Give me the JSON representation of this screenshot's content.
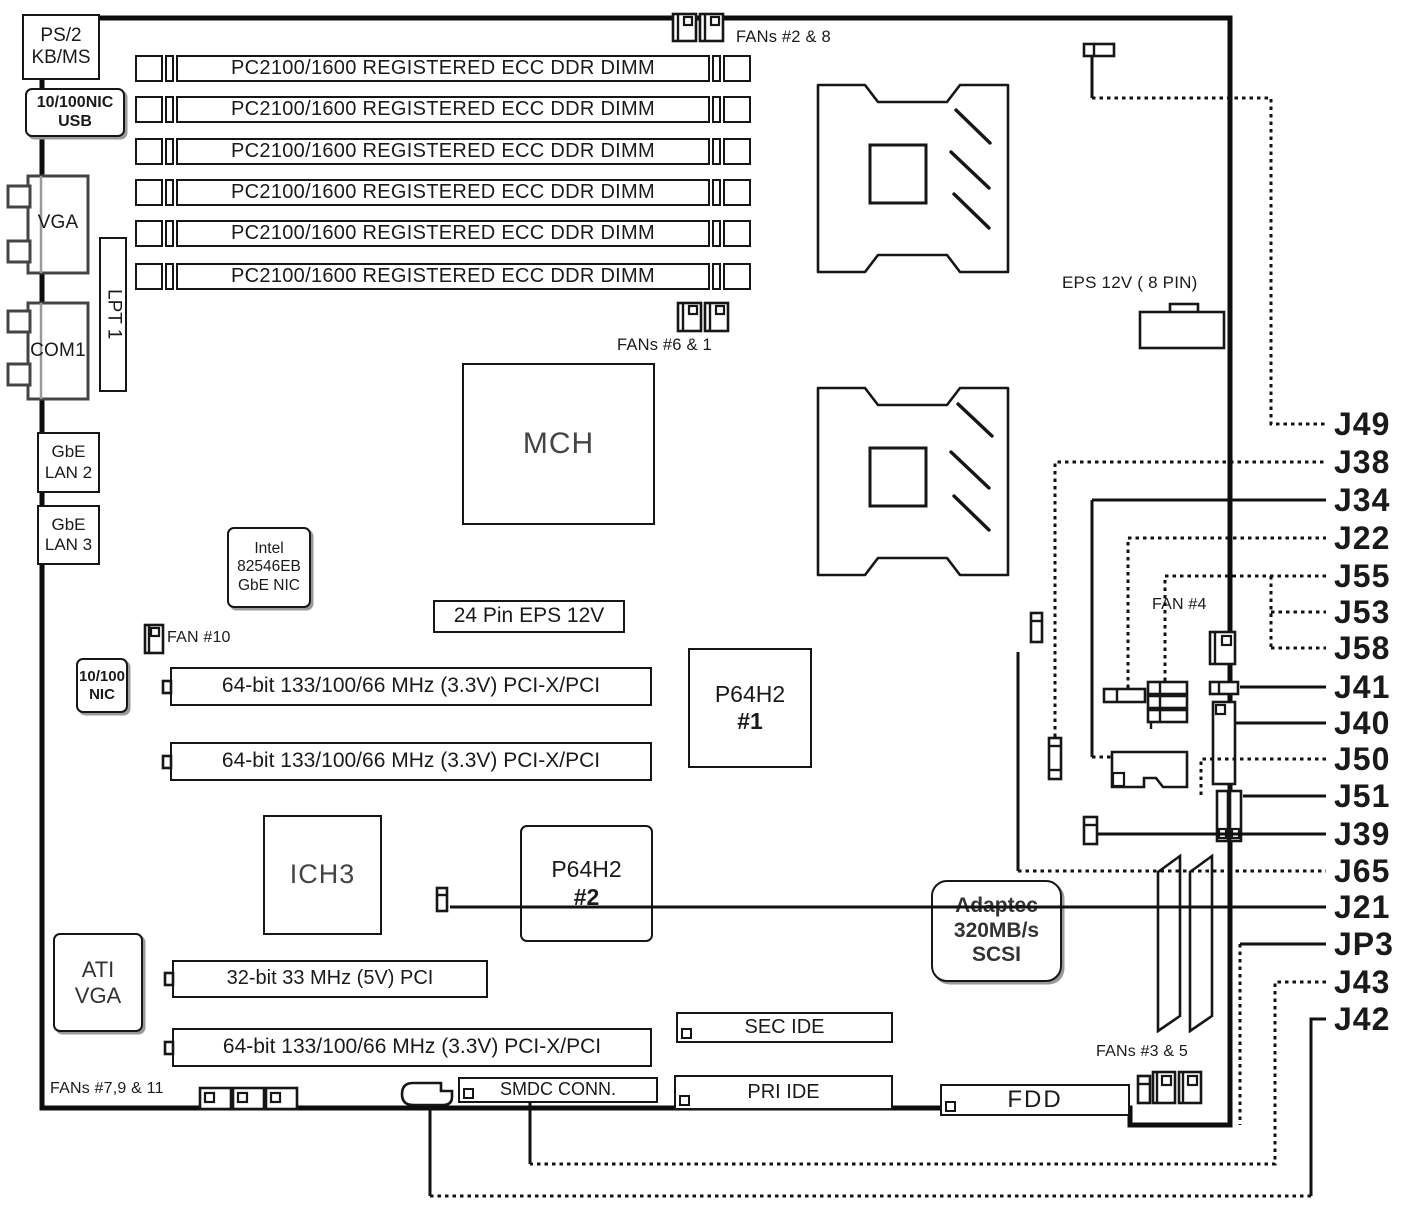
{
  "ports": {
    "ps2": "PS/2\nKB/MS",
    "nic_usb": "10/100NIC\nUSB",
    "vga": "VGA",
    "com1": "COM1",
    "lpt": "LPT 1",
    "lan2": "GbE\nLAN 2",
    "lan3": "GbE\nLAN 3",
    "nic_10_100": "10/100\nNIC"
  },
  "memory": {
    "dimm_label": "PC2100/1600 REGISTERED ECC DDR DIMM",
    "count": 6
  },
  "cpus": {
    "cpu1": "CPU 1",
    "cpu2": "CPU 2"
  },
  "chips": {
    "mch": "MCH",
    "intel_nic": "Intel\n82546EB\nGbE NIC",
    "ich3": "ICH3",
    "p64h2_name": "P64H2",
    "p64h2_1_num": "#1",
    "p64h2_2_num": "#2",
    "ati_vga": "ATI\nVGA",
    "adaptec": "Adaptec\n320MB/s\nSCSI"
  },
  "power": {
    "eps8_label": "EPS 12V ( 8 PIN)",
    "eps24_label": "24 Pin EPS 12V"
  },
  "slots": {
    "pcix_label": "64-bit 133/100/66 MHz (3.3V) PCI-X/PCI",
    "pci32_label": "32-bit 33 MHz (5V) PCI"
  },
  "storage": {
    "sec_ide": "SEC IDE",
    "pri_ide": "PRI IDE",
    "smdc": "SMDC CONN.",
    "fdd": "FDD"
  },
  "fans": {
    "fans_2_8": "FANs #2 & 8",
    "fans_6_1": "FANs #6 & 1",
    "fan_10": "FAN #10",
    "fan_4": "FAN #4",
    "fans_3_5": "FANs #3 & 5",
    "fans_7_9_11": "FANs #7,9 & 11"
  },
  "jumpers": [
    "J49",
    "J38",
    "J34",
    "J22",
    "J55",
    "J53",
    "J58",
    "J41",
    "J40",
    "J50",
    "J51",
    "J39",
    "J65",
    "J21",
    "JP3",
    "J43",
    "J42"
  ]
}
